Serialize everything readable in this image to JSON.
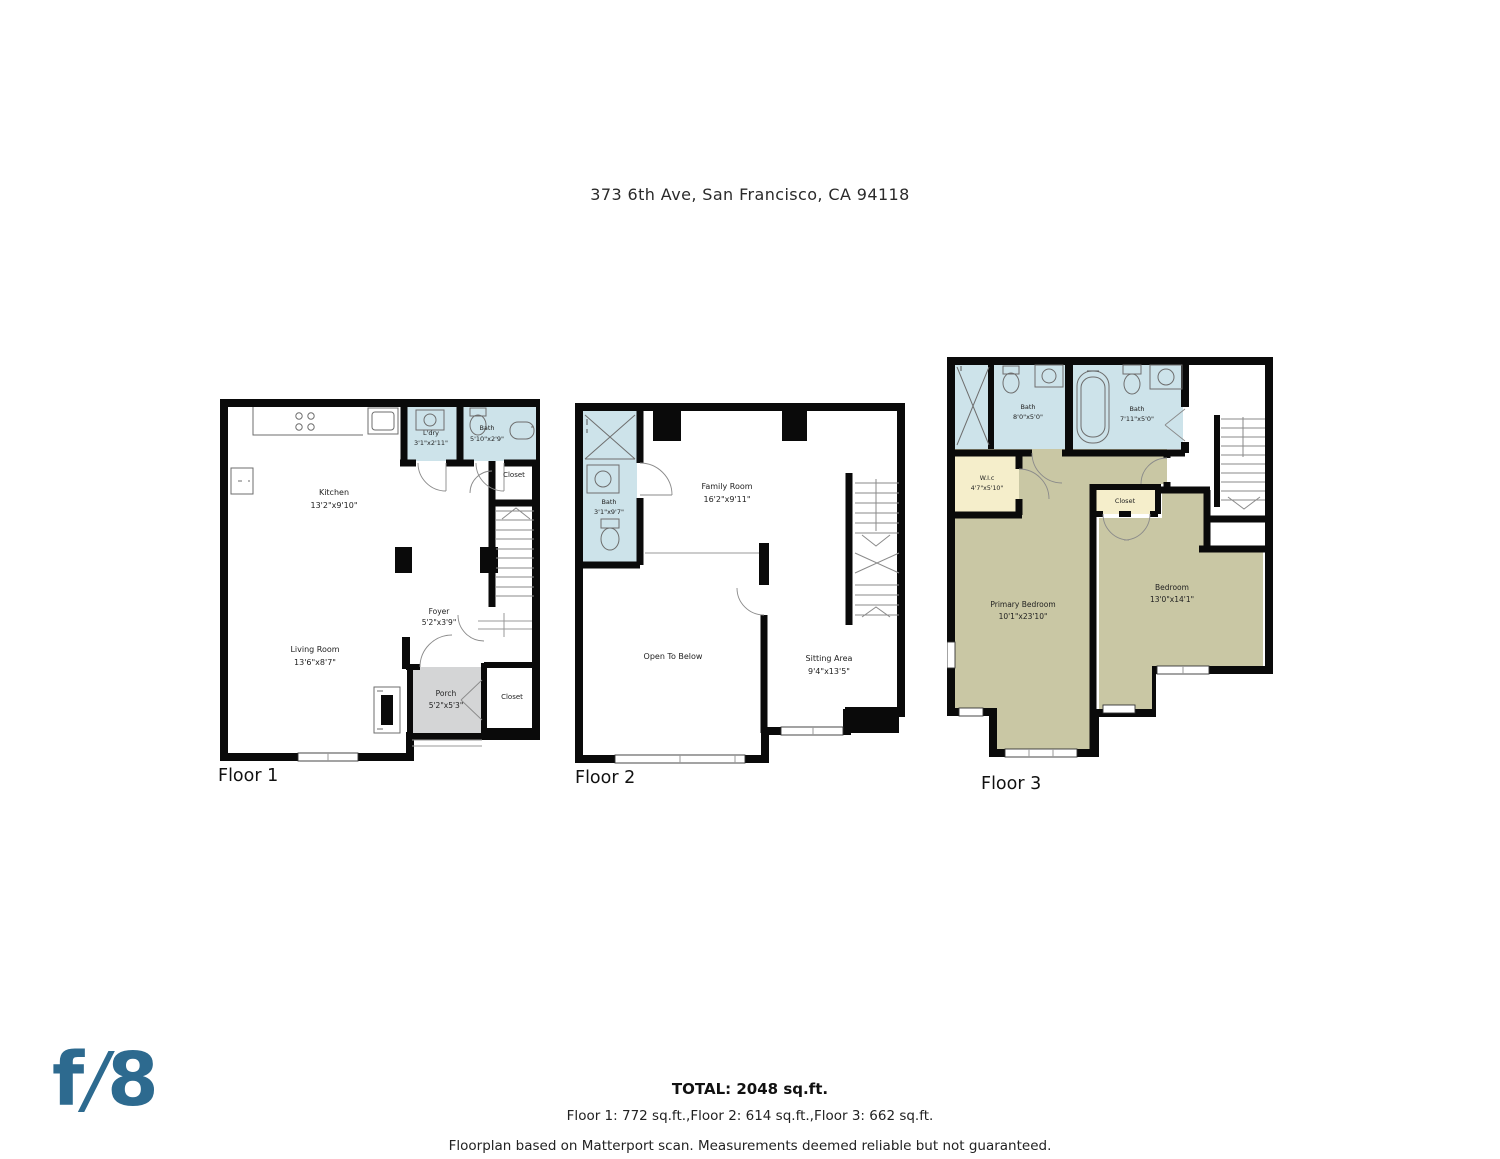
{
  "title": "373 6th Ave, San Francisco, CA 94118",
  "colors": {
    "room_fill": "#f5eecb",
    "bath_fill": "#cde3ea",
    "bedroom_fill": "#c9c7a4",
    "porch_fill": "#d4d5d6",
    "wall": "#0a0a0a",
    "logo_blue": "#2d6a8f"
  },
  "floors": [
    {
      "caption": "Floor 1",
      "rooms": [
        {
          "name": "Kitchen",
          "dims": "13'2\"x9'10\""
        },
        {
          "name": "L'dry",
          "dims": "3'1\"x2'11\""
        },
        {
          "name": "Bath",
          "dims": "5'10\"x2'9\""
        },
        {
          "name": "Closet",
          "dims": ""
        },
        {
          "name": "Foyer",
          "dims": "5'2\"x3'9\""
        },
        {
          "name": "Living Room",
          "dims": "13'6\"x8'7\""
        },
        {
          "name": "Porch",
          "dims": "5'2\"x5'3\""
        },
        {
          "name": "Closet",
          "dims": ""
        }
      ]
    },
    {
      "caption": "Floor 2",
      "rooms": [
        {
          "name": "Bath",
          "dims": "3'1\"x9'7\""
        },
        {
          "name": "Family Room",
          "dims": "16'2\"x9'11\""
        },
        {
          "name": "Open To Below",
          "dims": ""
        },
        {
          "name": "Sitting Area",
          "dims": "9'4\"x13'5\""
        }
      ]
    },
    {
      "caption": "Floor 3",
      "rooms": [
        {
          "name": "Bath",
          "dims": "8'0\"x5'0\""
        },
        {
          "name": "Bath",
          "dims": "7'11\"x5'0\""
        },
        {
          "name": "W.I.c",
          "dims": "4'7\"x5'10\""
        },
        {
          "name": "Closet",
          "dims": ""
        },
        {
          "name": "Primary Bedroom",
          "dims": "10'1\"x23'10\""
        },
        {
          "name": "Bedroom",
          "dims": "13'0\"x14'1\""
        }
      ]
    }
  ],
  "summary": {
    "total": "TOTAL: 2048 sq.ft.",
    "breakdown": "Floor 1: 772 sq.ft.,Floor 2: 614 sq.ft.,Floor 3: 662 sq.ft.",
    "disclaimer": "Floorplan based on Matterport scan. Measurements deemed reliable but not guaranteed."
  },
  "logo": {
    "f": "f",
    "slash": "/",
    "eight": "8"
  }
}
